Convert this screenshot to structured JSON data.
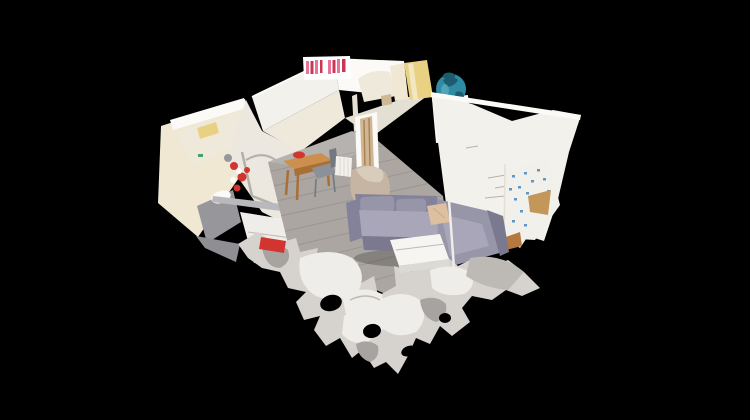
{
  "scene": {
    "background": "#000000"
  },
  "palette": {
    "bg": "#000000",
    "wall_white": "#f3f1ec",
    "wall_bright": "#fbfaf7",
    "wall_warm": "#efe9dc",
    "wall_shadow": "#e4dfd3",
    "wall_cream": "#f0e8d3",
    "wall_inner": "#ece8df",
    "accent_yellow": "#e9d183",
    "yellow_light": "#f2e7c0",
    "panel_gray": "#97979b",
    "panel_dark": "#8f8f93",
    "green_dot": "#46a06a",
    "bottle_pink": "#e8749a",
    "bottle_red": "#c93755",
    "white": "#ffffff",
    "floor_gray": "#aba6a2",
    "plank_line": "#8b8683",
    "floor_orange": "#b5793f",
    "table_wood": "#cd8f4e",
    "table_wood_dark": "#a96f33",
    "red_accent": "#d23530",
    "chair_gray": "#8d9097",
    "chair_dark": "#74787f",
    "radiator_white": "#f2f0ea",
    "radiator_line": "#dbd7cd",
    "door_tan": "#cdb795",
    "door_rust": "#a5713f",
    "threshold_tan": "#b9ab90",
    "blob_tan": "#c5b5a2",
    "blob_light": "#d8ccba",
    "sofa_gray": "#9795a8",
    "sofa_light": "#a8a6b8",
    "sofa_dark": "#84829a",
    "sofa_deep": "#7b7990",
    "pillow_beige": "#ddc09f",
    "pillow_line": "#c8a888",
    "lamp_white": "#efede8",
    "teal_globe": "#2f8ba4",
    "teal_dark": "#1d5b6e",
    "teal_light": "#63aec1",
    "dresser_slot": "#cfcdc8",
    "bed_white": "#f2f0eb",
    "blue_floral": "#5b97c8",
    "wood_tan": "#c49659",
    "metal_gray": "#b9b9bd",
    "arm_gray": "#b3b0ac",
    "blue_item": "#2e6fbf",
    "teal_item": "#49b8c8",
    "frag_base": "#d6d2ce",
    "frag_light": "#efedea",
    "frag_dark": "#a7a3a0",
    "frag_mid": "#bdbab6",
    "table_white": "#f6f5f2",
    "table_white_side": "#dcdad5",
    "seam_gray": "#bdbab4",
    "scribble": "#b7b2a8"
  }
}
